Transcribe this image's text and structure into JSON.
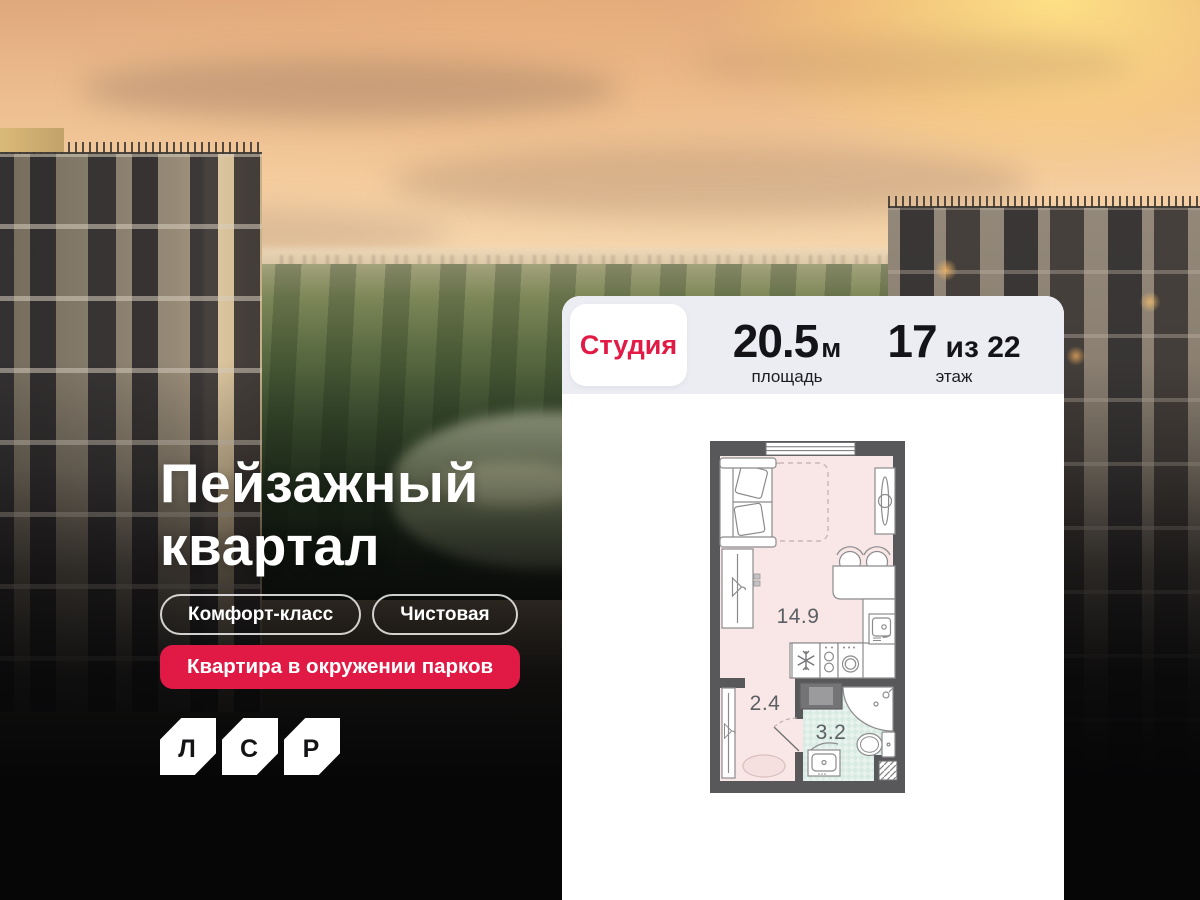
{
  "hero": {
    "title_line1": "Пейзажный",
    "title_line2": "квартал",
    "badge_1": "Комфорт-класс",
    "badge_2": "Чистовая",
    "highlight_badge": "Квартира в окружении парков",
    "logo": {
      "letter_1": "Л",
      "letter_2": "С",
      "letter_3": "Р"
    }
  },
  "card": {
    "type_label": "Студия",
    "area_value": "20.5",
    "area_unit": "м",
    "area_label": "площадь",
    "floor_value": "17",
    "floor_total": "из 22",
    "floor_label": "этаж",
    "plan_rooms": {
      "main": "14.9",
      "hall": "2.4",
      "bath": "3.2"
    }
  },
  "colors": {
    "accent_red": "#e01a45",
    "card_header_bg": "#ebedf3",
    "plan_wall": "#58585a",
    "plan_floor_main": "#f8e7e6",
    "plan_floor_bath": "#e8f2ee",
    "sky_warm": "#f4cc9e",
    "overlay_dark": "#060607"
  }
}
